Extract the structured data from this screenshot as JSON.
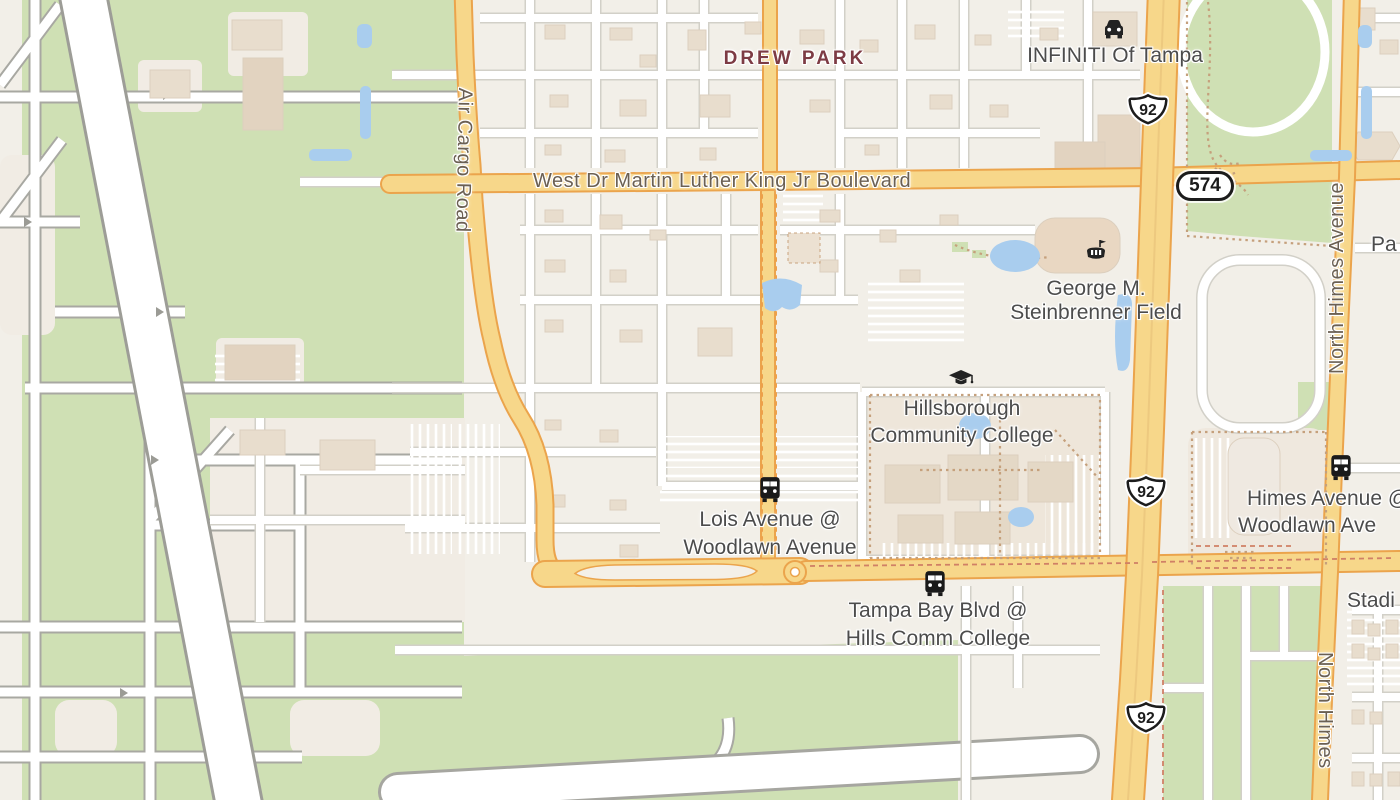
{
  "labels": {
    "neighborhood": "DREW PARK",
    "poi_infiniti": "INFINITI Of Tampa",
    "poi_steinbrenner_line1": "George M.",
    "poi_steinbrenner_line2": "Steinbrenner Field",
    "poi_hcc_line1": "Hillsborough",
    "poi_hcc_line2": "Community College",
    "road_mlk": "West Dr Martin Luther King Jr Boulevard",
    "road_air_cargo": "Air Cargo Road",
    "road_north_himes": "North Himes Avenue",
    "road_north_himes_partial": "North Himes",
    "stop_lois_line1": "Lois Avenue @",
    "stop_lois_line2": "Woodlawn Avenue",
    "stop_tbb_line1": "Tampa Bay Blvd @",
    "stop_tbb_line2": "Hills Comm College",
    "stop_himes_line1": "Himes Avenue @",
    "stop_himes_line2": "Woodlawn Ave",
    "partial_stadium": "Stadi",
    "partial_pa": "Pa"
  },
  "shields": {
    "us92": "92",
    "sr574": "574"
  },
  "icons": {
    "car": "car-dealership-icon",
    "stadium": "stadium-icon",
    "graduation_cap": "college-icon",
    "bus": "bus-stop-icon"
  },
  "colors": {
    "background": "#f2efe8",
    "park_green": "#cfe0b4",
    "road_yellow": "#f7d78a",
    "road_casing_orange": "#eba44c",
    "water_blue": "#a9cdee",
    "building_tan": "#e8ddcd",
    "label_gray": "#4c4c4c",
    "road_label_brown": "#6b6053",
    "neighborhood_maroon": "#7d3b44",
    "dashed_path_brown": "#c5a07c",
    "dashed_red": "#d08066"
  }
}
